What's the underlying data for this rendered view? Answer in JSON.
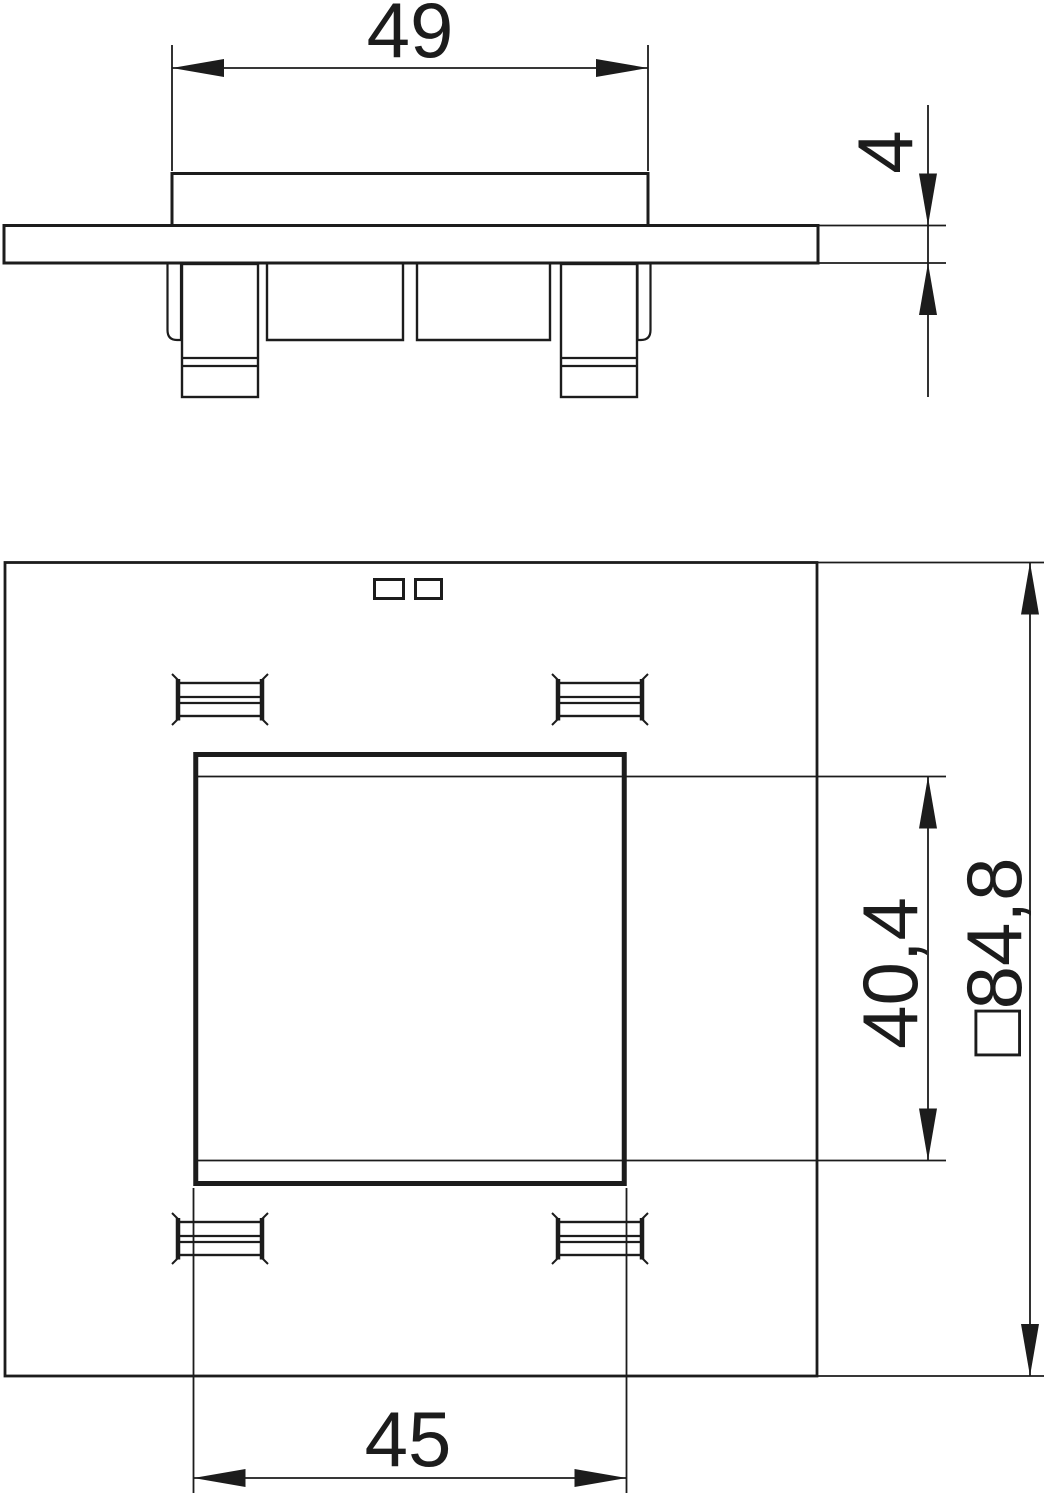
{
  "colors": {
    "line": "#1c1c1c",
    "background": "#ffffff"
  },
  "views": {
    "side": {
      "labels": {
        "cover_width": "49",
        "flange_thickness": "4"
      }
    },
    "plan": {
      "labels": {
        "cutout_width": "45",
        "cutout_inner_height": "40,4",
        "plate_size": "□84,8"
      }
    }
  }
}
